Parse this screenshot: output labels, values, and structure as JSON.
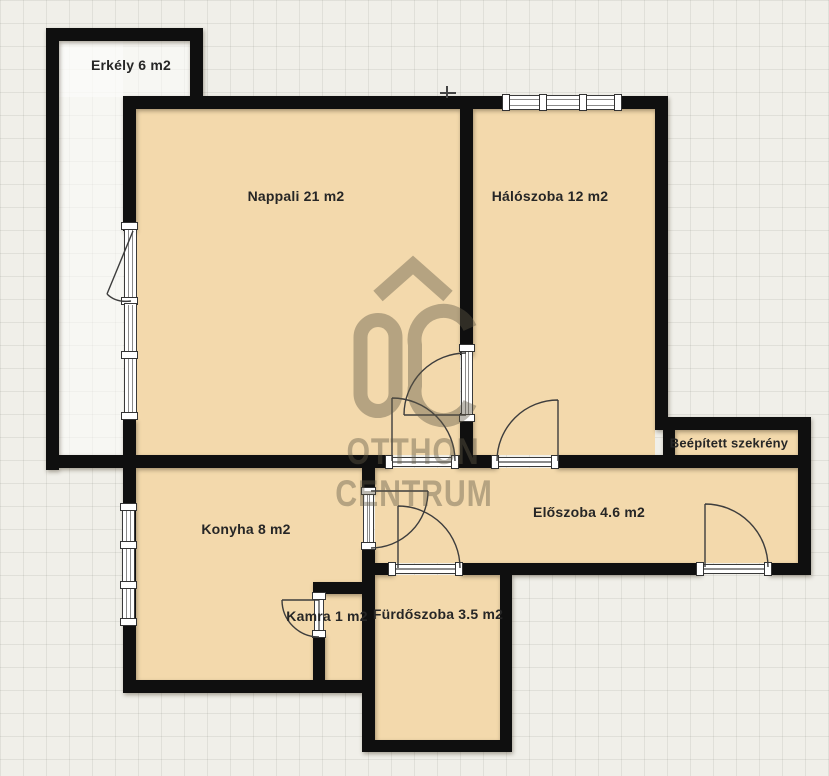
{
  "rooms": {
    "erkely": {
      "label": "Erkély 6 m2"
    },
    "nappali": {
      "label": "Nappali 21 m2"
    },
    "haloszoba": {
      "label": "Hálószoba 12 m2"
    },
    "szekreny": {
      "label": "Beépített szekrény"
    },
    "eloszoba": {
      "label": "Előszoba 4.6 m2"
    },
    "konyha": {
      "label": "Konyha 8 m2"
    },
    "kamra": {
      "label": "Kamra 1 m2"
    },
    "furdoszoba": {
      "label": "Fürdőszoba 3.5 m2"
    }
  },
  "watermark": {
    "monogram": "OC",
    "brand_line1": "OTTHON",
    "brand_line2": "CENTRUM"
  },
  "colors": {
    "room_fill": "#f3d9ac",
    "wall": "#0f0f0f",
    "background": "#f0efe9",
    "watermark": "rgba(95,88,70,0.42)",
    "label_text": "#262626"
  }
}
